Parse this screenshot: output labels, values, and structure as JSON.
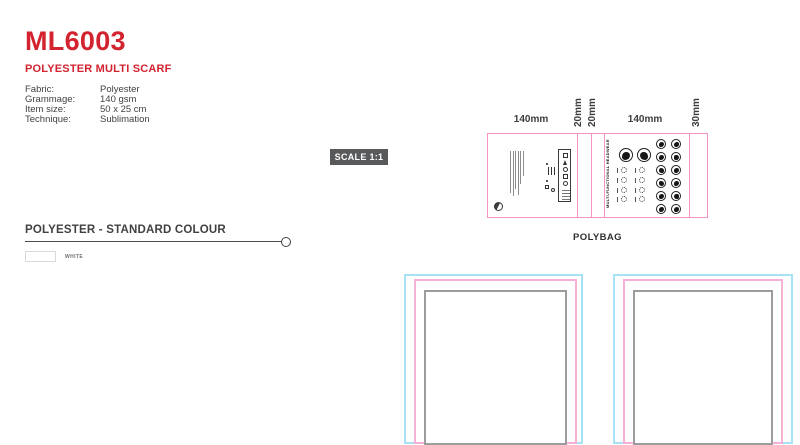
{
  "title_block": {
    "product_code": "ML6003",
    "product_name": "POLYESTER MULTI SCARF",
    "specs": [
      {
        "label": "Fabric:",
        "value": "Polyester"
      },
      {
        "label": "Grammage:",
        "value": "140 gsm"
      },
      {
        "label": "Item size:",
        "value": "50 x 25 cm"
      },
      {
        "label": "Technique:",
        "value": "Sublimation"
      }
    ]
  },
  "scale_badge": {
    "label": "SCALE 1:1"
  },
  "polybag": {
    "caption": "POLYBAG",
    "dim_labels": [
      "140mm",
      "20mm",
      "20mm",
      "140mm",
      "30mm"
    ],
    "right_panel_title": "MULTI-FUNCTIONAL HEADWEAR"
  },
  "colour_section": {
    "title": "POLYESTER - STANDARD COLOUR",
    "swatches": [
      {
        "name": "WHITE",
        "hex": "#ffffff"
      }
    ]
  },
  "colors": {
    "brand_red": "#d2232f",
    "badge_bg": "#58595b",
    "polybag_outline": "#f494c4",
    "template_outer_cyan": "#a7e1f6",
    "template_mid_pink": "#f8b1d6",
    "template_inner_gray": "#9c9c9c",
    "text_dark": "#414042"
  }
}
